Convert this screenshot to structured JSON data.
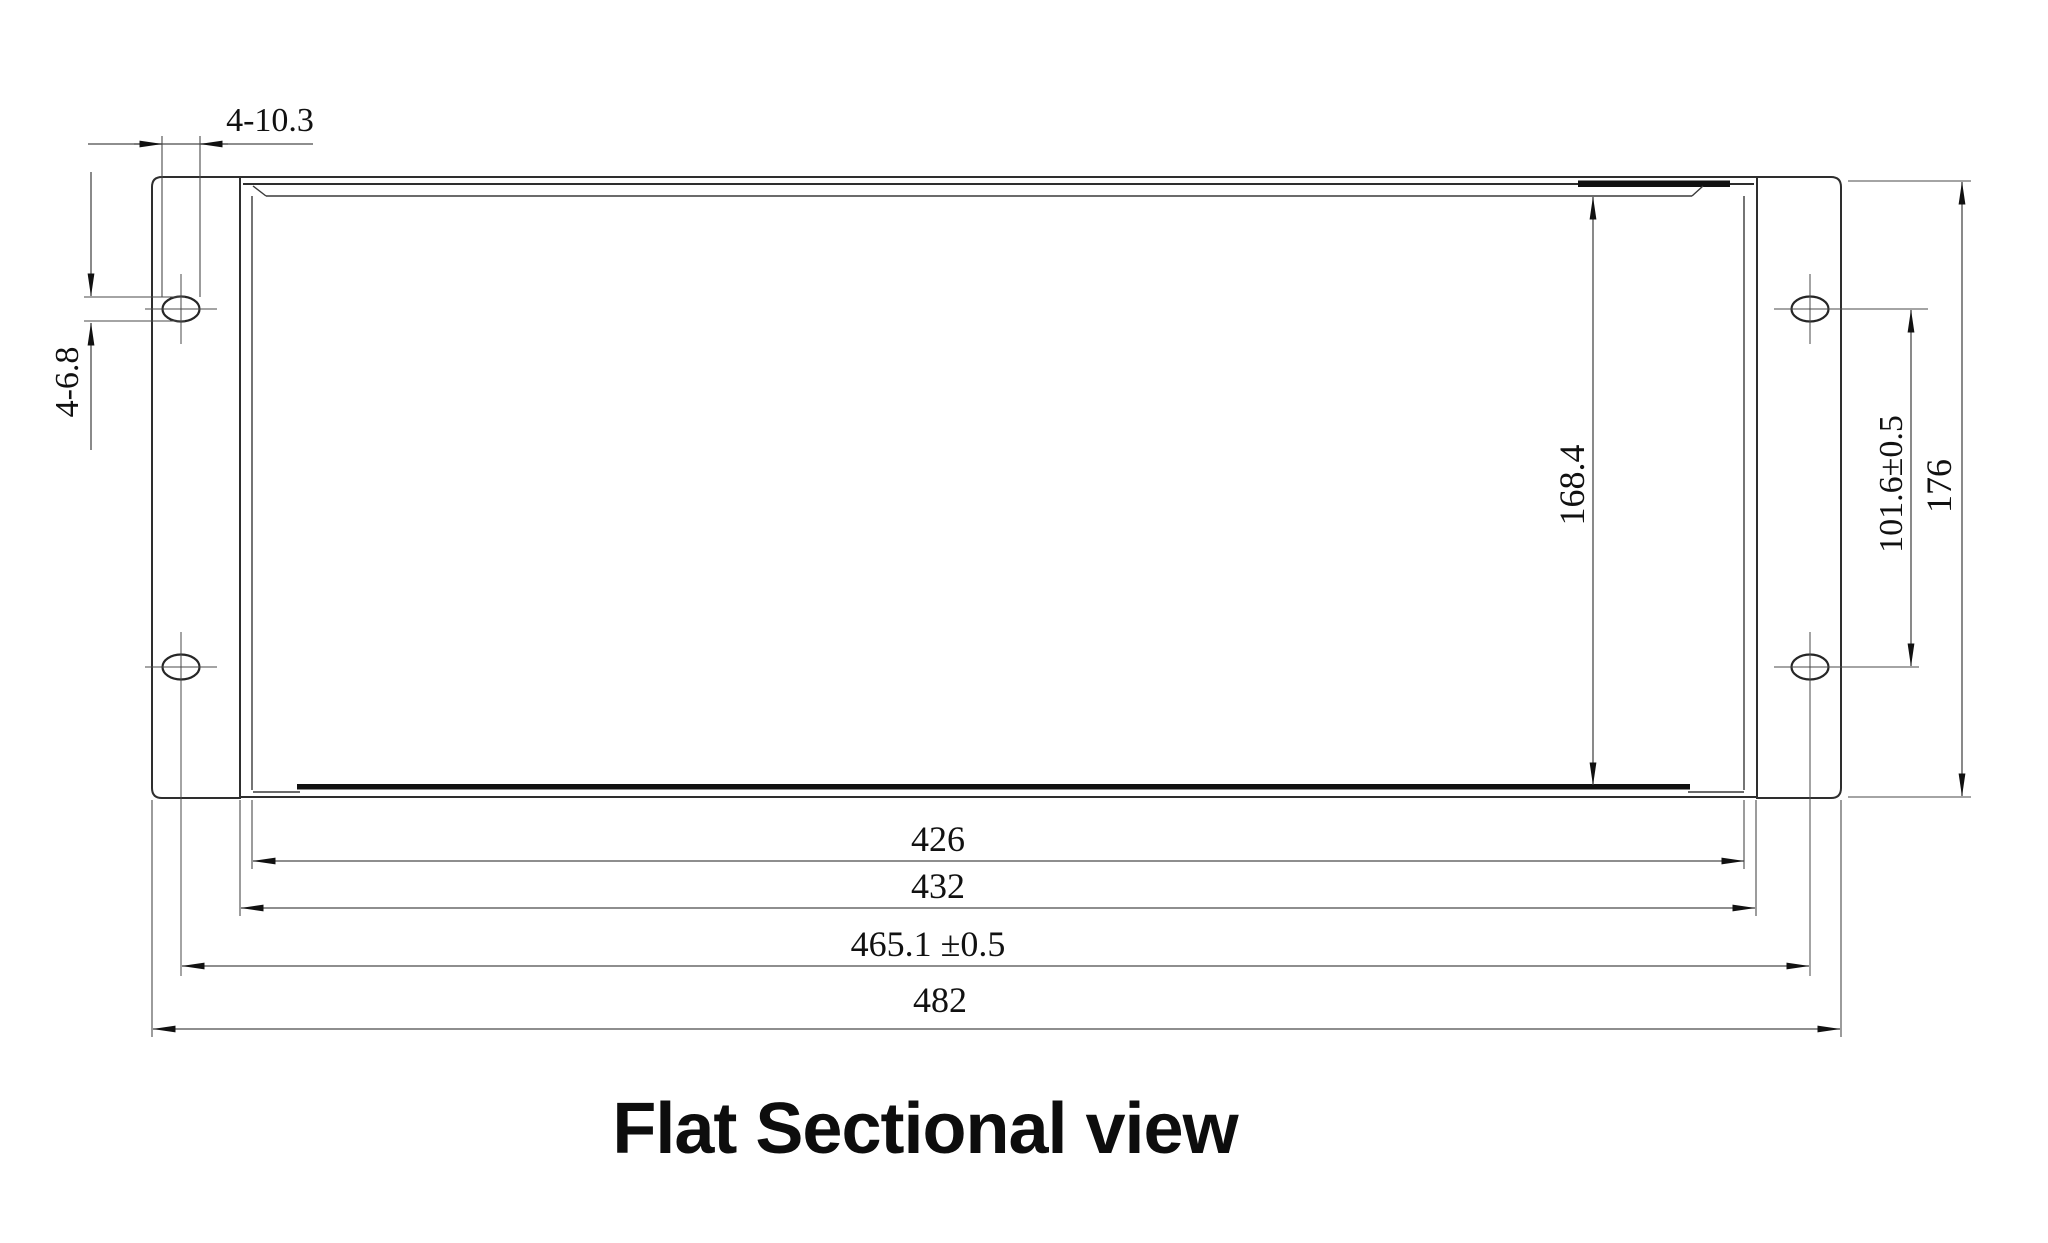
{
  "title": "Flat Sectional view",
  "dims": {
    "top_slot_width": "4-10.3",
    "left_slot_height": "4-6.8",
    "inner_height": "168.4",
    "hole_pitch_vertical": "101.6±0.5",
    "overall_height": "176",
    "inner_width": "426",
    "body_width": "432",
    "hole_pitch_horizontal": "465.1 ±0.5",
    "overall_width": "482"
  }
}
